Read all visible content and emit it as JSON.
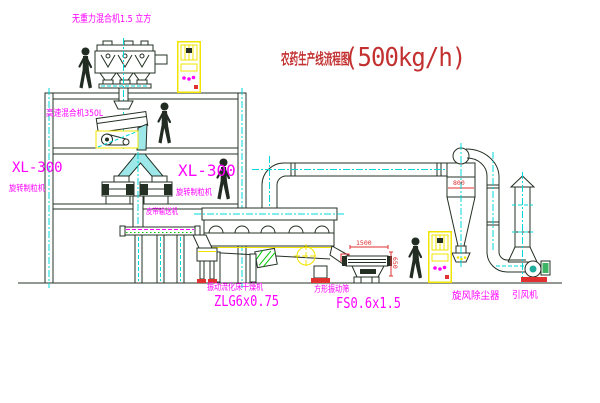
{
  "title": {
    "name": "农药生产线流程图",
    "capacity": "(500kg/h)"
  },
  "labels": {
    "zero_gravity_mixer": "无重力混合机1.5 立方",
    "high_speed_mixer": "高速混合机350L",
    "granulator_left_model": "XL-300",
    "granulator_left_name": "旋转制粒机",
    "granulator_right_model": "XL-300",
    "granulator_right_name": "旋转制粒机",
    "belt_conveyor": "皮带输送机",
    "dryer_name": "振动流化床干燥机",
    "dryer_model": "ZLG6x0.75",
    "screen_name": "方形振动筛",
    "screen_model": "FS0.6x1.5",
    "cyclone": "旋风除尘器",
    "fan": "引风机"
  },
  "dimensions": {
    "screen_length": "1500",
    "screen_height": "650",
    "cyclone_body": "800"
  },
  "colors": {
    "line": "#243024",
    "label_magenta": "#ff00ff",
    "title_red": "#c23030",
    "dim_red": "#e03030",
    "centerline_cyan": "#00d8d8",
    "machine_yellow": "#f0e400",
    "conveyor_green": "#00c800",
    "background": "#ffffff"
  }
}
